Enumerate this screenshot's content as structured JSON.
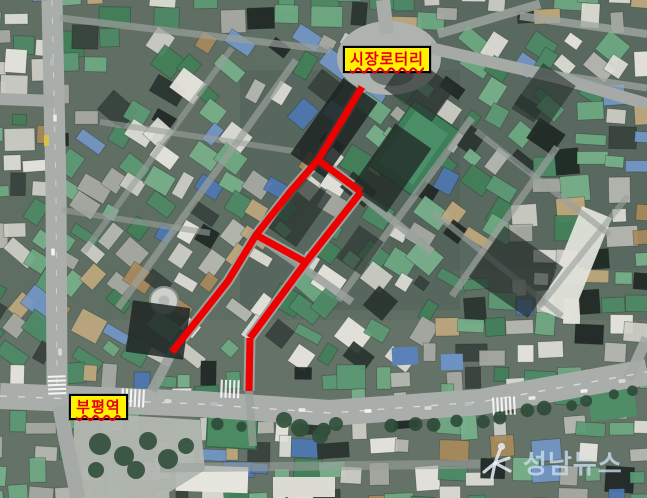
{
  "map": {
    "labels": [
      {
        "id": "sijang-rotary",
        "text": "시장로터리",
        "x": 343,
        "y": 46,
        "w": 88,
        "h": 27
      },
      {
        "id": "bupyeong-station",
        "text": "부평역",
        "x": 69,
        "y": 394,
        "w": 59,
        "h": 26
      }
    ],
    "label_style": {
      "background": "#fff200",
      "border_color": "#000000",
      "text_color": "#e60012",
      "underline": "wavy-red"
    },
    "route": {
      "color": "#ee0000",
      "stroke_width": 7,
      "polylines": [
        [
          [
            362,
            87
          ],
          [
            318,
            160
          ],
          [
            290,
            192
          ],
          [
            256,
            235
          ],
          [
            228,
            281
          ],
          [
            172,
            352
          ]
        ],
        [
          [
            318,
            160
          ],
          [
            361,
            192
          ]
        ],
        [
          [
            361,
            192
          ],
          [
            306,
            262
          ],
          [
            250,
            338
          ]
        ],
        [
          [
            256,
            235
          ],
          [
            307,
            263
          ]
        ],
        [
          [
            250,
            338
          ],
          [
            249,
            391
          ]
        ]
      ]
    },
    "watermark": {
      "text": "성남뉴스",
      "color": "rgba(201,220,237,0.8)",
      "logo": "seongnam-news-logo"
    }
  }
}
